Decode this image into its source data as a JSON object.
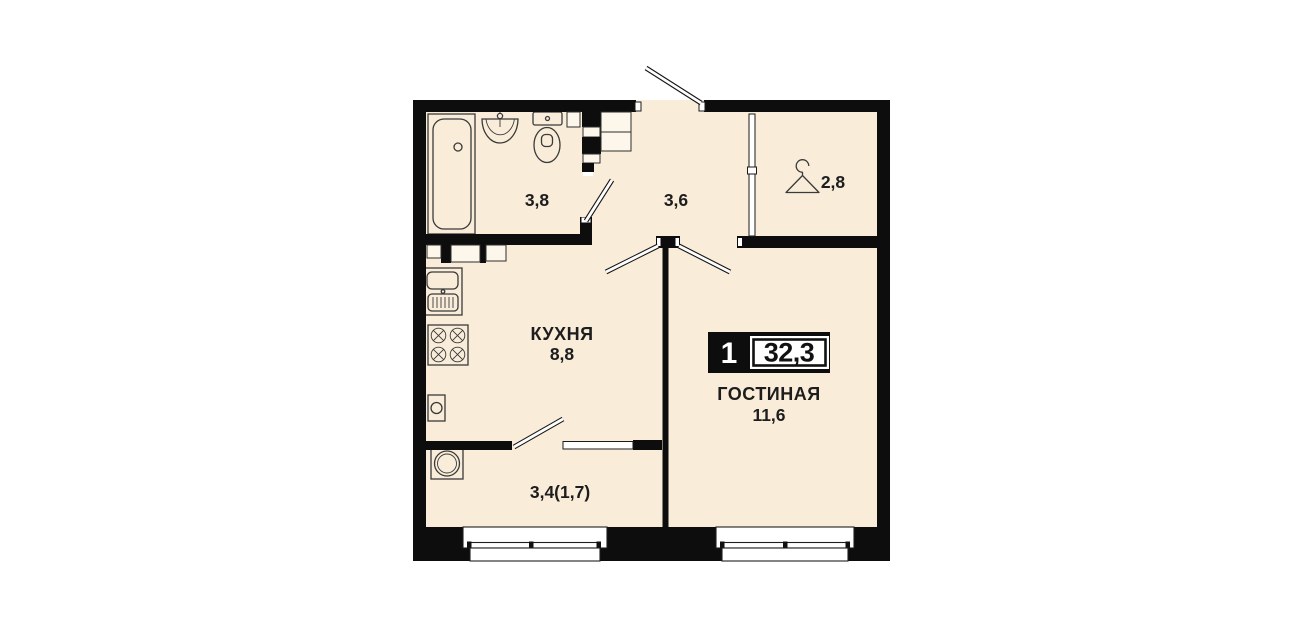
{
  "plan": {
    "badge": {
      "rooms_count": "1",
      "total_area": "32,3"
    },
    "rooms": [
      {
        "key": "bathroom",
        "name": "",
        "area": "3,8"
      },
      {
        "key": "hallway",
        "name": "",
        "area": "3,6"
      },
      {
        "key": "wardrobe",
        "name": "",
        "area": "2,8"
      },
      {
        "key": "kitchen",
        "name": "КУХНЯ",
        "area": "8,8"
      },
      {
        "key": "living-room",
        "name": "ГОСТИНАЯ",
        "area": "11,6"
      },
      {
        "key": "balcony",
        "name": "",
        "area": "3,4(1,7)"
      }
    ],
    "colors": {
      "floor": "#f9edda",
      "wall": "#0d0d0d",
      "text": "#1d1d1d"
    }
  }
}
